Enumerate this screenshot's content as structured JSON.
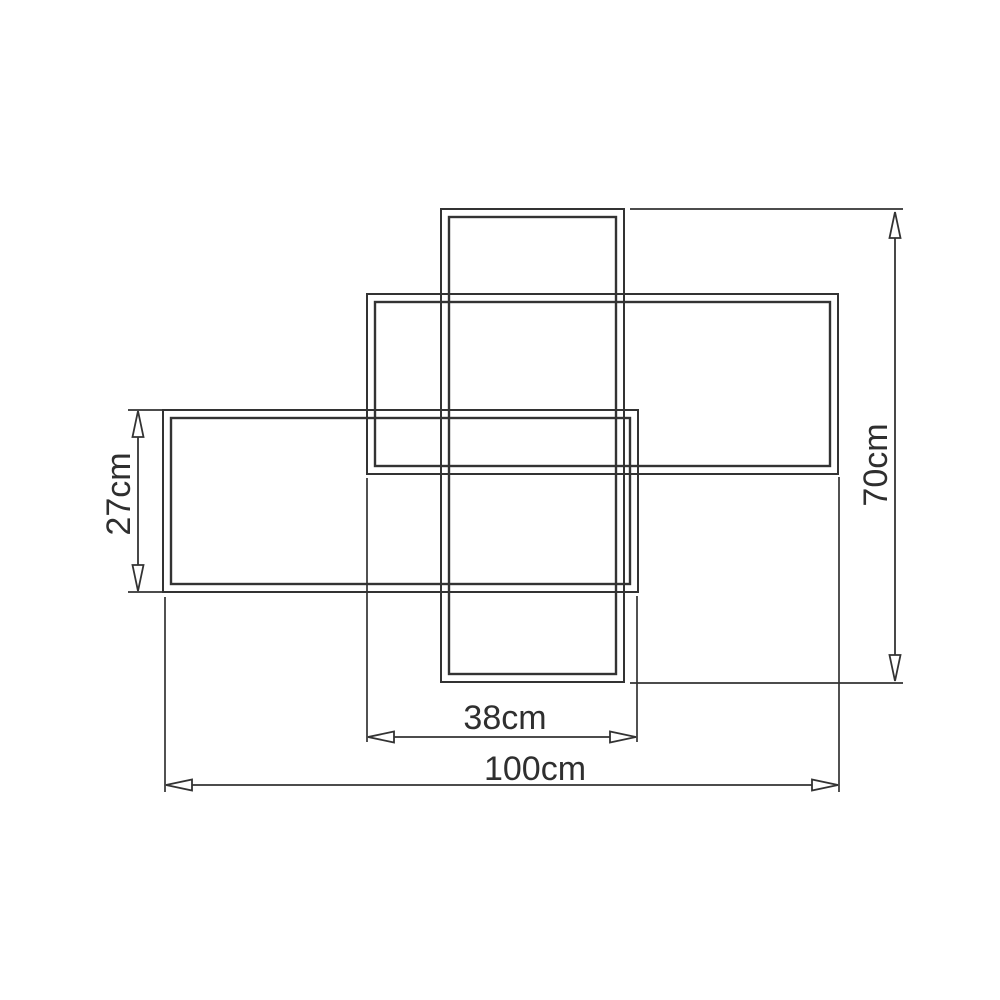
{
  "drawing": {
    "type": "technical dimension drawing of overlapping rectangular panels",
    "unit": "cm",
    "colors": {
      "line": "#333333",
      "text": "#2f2f2f",
      "background": "#ffffff"
    },
    "panels": [
      {
        "name": "center-vertical-panel"
      },
      {
        "name": "top-right-panel"
      },
      {
        "name": "left-panel"
      }
    ],
    "dimensions": {
      "left_panel_height": {
        "label": "27cm",
        "value": 27,
        "orientation": "vertical"
      },
      "overall_height": {
        "label": "70cm",
        "value": 70,
        "orientation": "vertical"
      },
      "center_width": {
        "label": "38cm",
        "value": 38,
        "orientation": "horizontal"
      },
      "overall_width": {
        "label": "100cm",
        "value": 100,
        "orientation": "horizontal"
      }
    }
  }
}
